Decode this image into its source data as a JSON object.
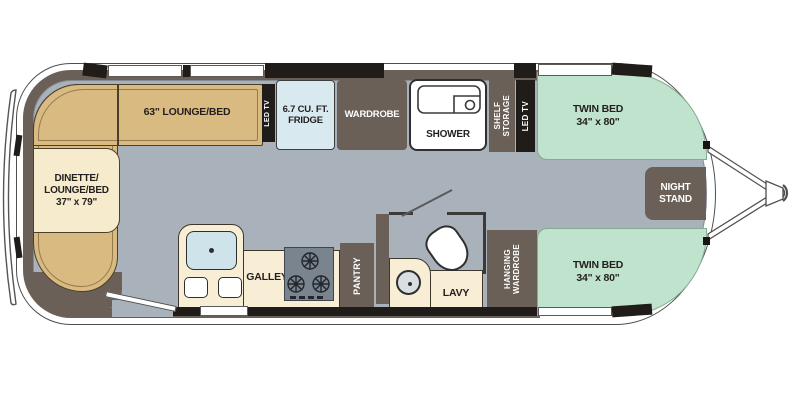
{
  "title": "Travel trailer floor plan",
  "colors": {
    "wall": "#6a6058",
    "floor": "#a9b2ba",
    "shell": "#ffffff",
    "lounge_tan": "#d9ba80",
    "dinette_cream": "#f6eccd",
    "counter_cream": "#f8eed6",
    "bed_green": "#c0e3cd",
    "fridge_blue": "#d9e9f0",
    "sink_blue": "#cfe3ea",
    "cabinet_dark": "#1f1c19",
    "cooktop_gray": "#79848e",
    "text_dark": "#231f20",
    "text_light": "#ffffff"
  },
  "labels": {
    "lounge_63": "63\" LOUNGE/BED",
    "dinette": "DINETTE/\nLOUNGE/BED\n37\" x 79\"",
    "led_tv_left": "LED TV",
    "fridge": "6.7 CU. FT.\nFRIDGE",
    "wardrobe": "WARDROBE",
    "shower": "SHOWER",
    "shelf_storage": "SHELF\nSTORAGE",
    "led_tv_right": "LED TV",
    "twin_bed_top": "TWIN BED\n34\" x 80\"",
    "twin_bed_bottom": "TWIN BED\n34\" x 80\"",
    "night_stand": "NIGHT\nSTAND",
    "galley": "GALLEY",
    "pantry": "PANTRY",
    "lavy": "LAVY",
    "hanging_wardrobe": "HANGING\nWARDROBE"
  }
}
